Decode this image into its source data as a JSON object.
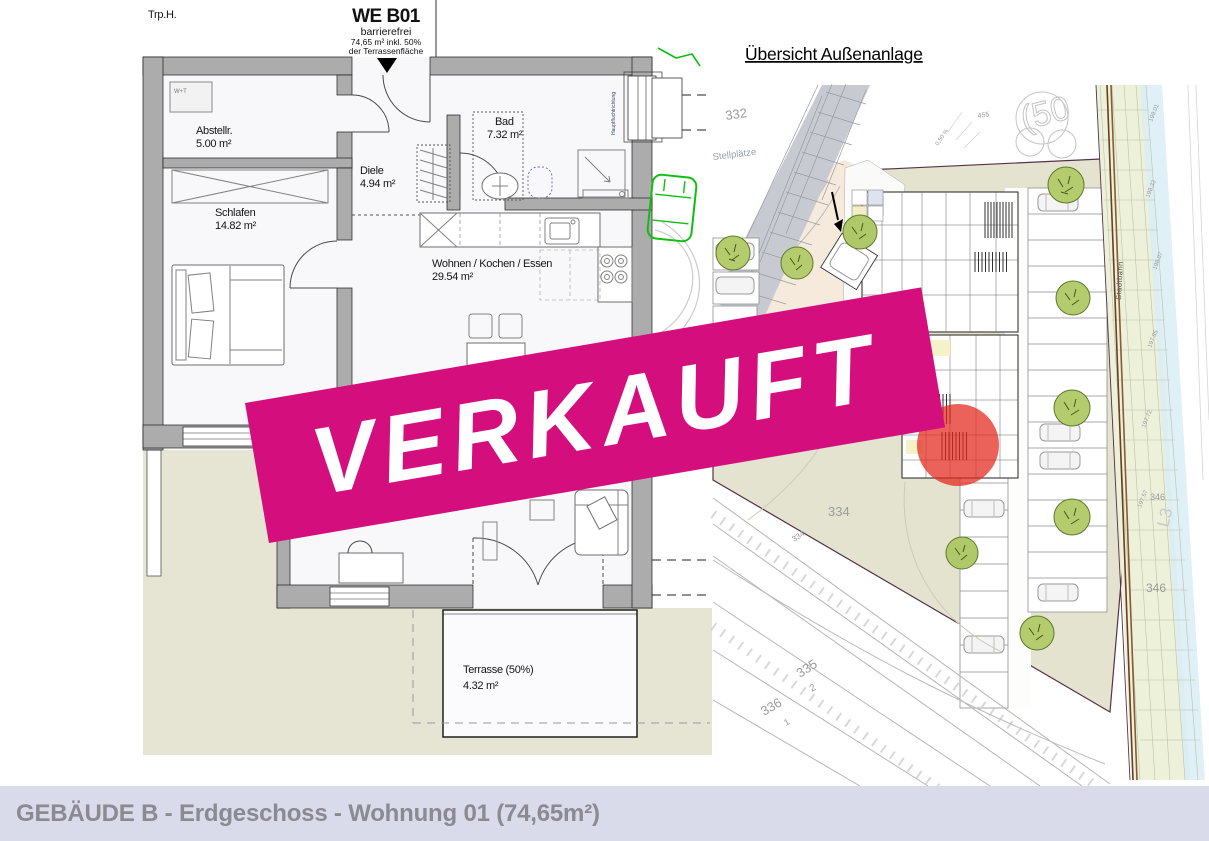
{
  "floor_plan": {
    "staircase_label": "Trp.H.",
    "unit": {
      "id": "WE B01",
      "accessibility": "barrierefrei",
      "area_note_line1": "74,65 m² inkl. 50%",
      "area_note_line2": "der Terrassenfläche"
    },
    "rooms": [
      {
        "name": "Abstellr.",
        "area": "5.00 m²"
      },
      {
        "name": "Schlafen",
        "area": "14.82 m²"
      },
      {
        "name": "Diele",
        "area": "4.94 m²"
      },
      {
        "name": "Bad",
        "area": "7.32 m²"
      },
      {
        "name": "Wohnen / Kochen / Essen",
        "area": "29.54 m²"
      },
      {
        "name": "Terrasse (50%)",
        "area": "4.32 m²"
      }
    ],
    "appliance_label": "W+T",
    "escape_route_label": "Hauptfluchtrichtung",
    "wall_color": "#ACACAC",
    "garden_color": "#E6E4D2"
  },
  "banner": {
    "label": "VERKAUFT",
    "color": "#D40F7D"
  },
  "site_plan": {
    "title": "Übersicht Außenanlage",
    "road_label": "Stellplätze",
    "rail_label": "Stadtbahn",
    "grade_label": "0,50 %",
    "parcel_labels": [
      {
        "text": "332"
      },
      {
        "text": "455"
      },
      {
        "text": "(50"
      },
      {
        "text": "334"
      },
      {
        "text": "334"
      },
      {
        "text": "335"
      },
      {
        "text": "2"
      },
      {
        "text": "336"
      },
      {
        "text": "1"
      },
      {
        "text": "346"
      },
      {
        "text": "346"
      },
      {
        "text": "L3"
      }
    ],
    "elevation_labels": [
      {
        "text": "198.01"
      },
      {
        "text": "198.33"
      },
      {
        "text": "198.07"
      },
      {
        "text": "197.85"
      },
      {
        "text": "197.72"
      },
      {
        "text": "197.57"
      }
    ],
    "parcel_color": "#E4E3D0",
    "highlight_color": "#E2261A"
  },
  "footer": {
    "title": "GEBÄUDE B - Erdgeschoss - Wohnung 01 (74,65m²)"
  }
}
